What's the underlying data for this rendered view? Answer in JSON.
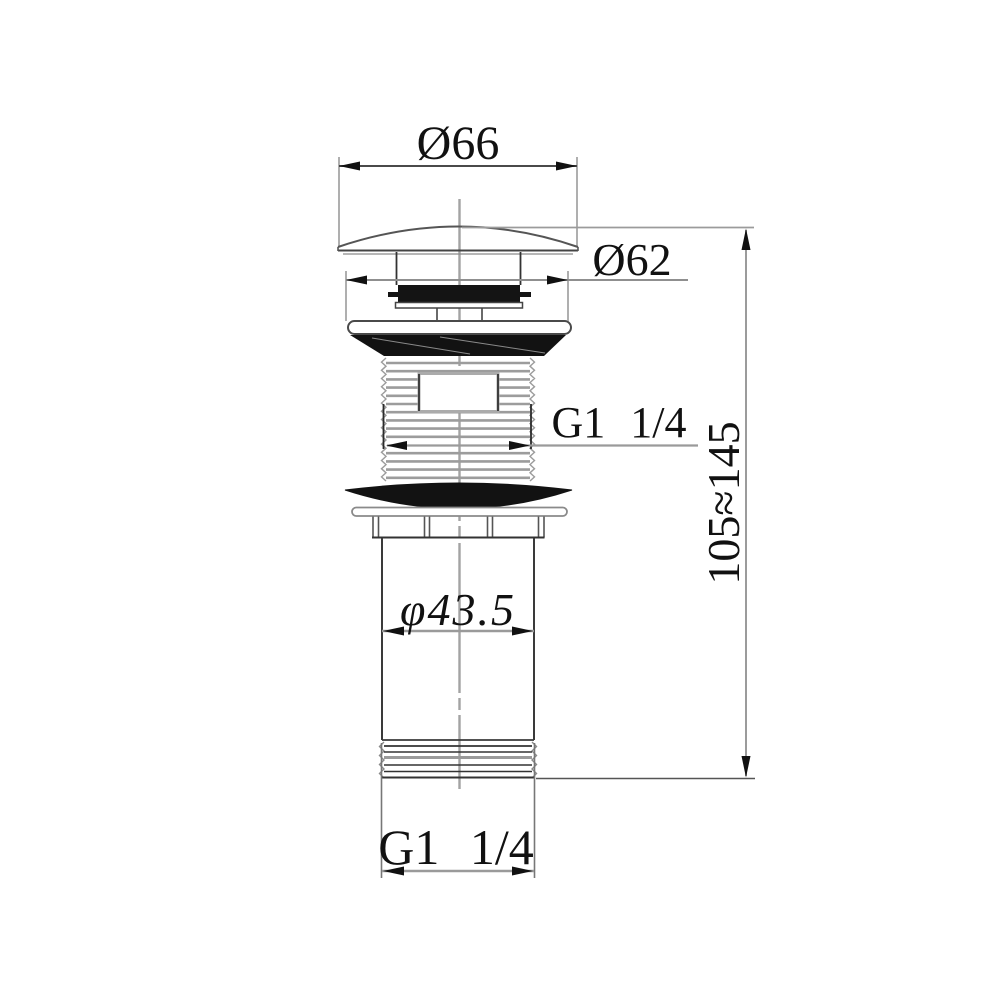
{
  "drawing": {
    "colors": {
      "background": "#ffffff",
      "outline": "#333333",
      "dim_line": "#979797",
      "black_fill": "#141414",
      "text": "#111111"
    },
    "dimensions": {
      "cap_diameter": "Ø66",
      "trim_diameter": "Ø62",
      "top_thread_size": "G1 1/4",
      "overall_height": "105≈145",
      "tailpipe_diameter": "φ43.5",
      "bottom_thread_size": "G1 1/4"
    }
  }
}
